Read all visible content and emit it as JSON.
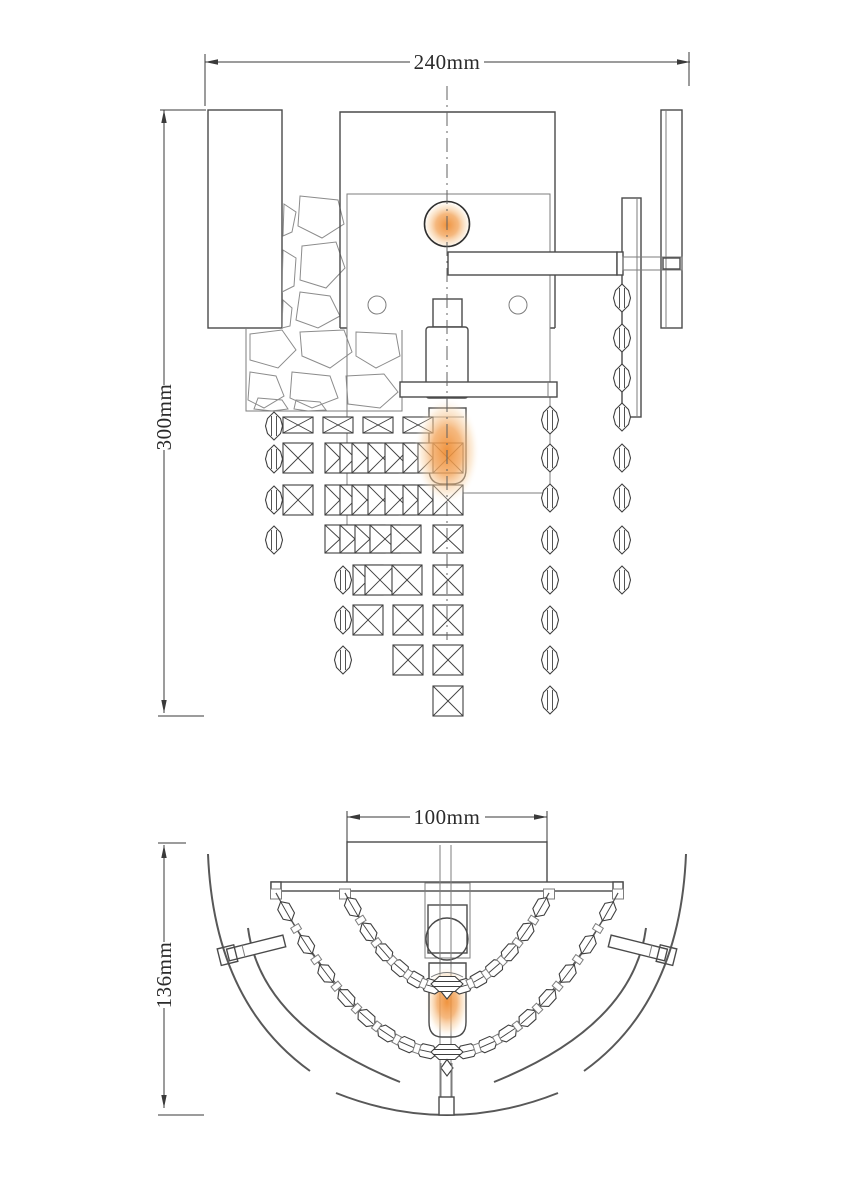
{
  "title": "Wall lamp technical drawing",
  "dimensions": {
    "front_width": "240mm",
    "front_height": "300mm",
    "shade_width": "100mm",
    "shade_depth": "136mm"
  },
  "colors": {
    "background": "#ffffff",
    "line_dark": "#4a4a4a",
    "line_thin": "#7d7d7d",
    "glow_core": "#ee8a2e",
    "glow_mid": "#f3a75f",
    "glow_soft": "#f9d6ab"
  },
  "views": {
    "front": {
      "square_size": 30,
      "square_rows": [
        {
          "y": 417,
          "h": 16,
          "xs": [
            283,
            323,
            363,
            403
          ]
        },
        {
          "y": 443,
          "h": 30,
          "xs": [
            283,
            325,
            340,
            352,
            368,
            385,
            403,
            418,
            433
          ]
        },
        {
          "y": 485,
          "h": 30,
          "xs": [
            283,
            325,
            340,
            352,
            368,
            385,
            403,
            418,
            433
          ]
        },
        {
          "y": 525,
          "h": 28,
          "xs": [
            325,
            340,
            355,
            370,
            391,
            433
          ]
        },
        {
          "y": 565,
          "h": 30,
          "xs": [
            353,
            365,
            392,
            433
          ]
        },
        {
          "y": 605,
          "h": 30,
          "xs": [
            353,
            393,
            433
          ]
        },
        {
          "y": 645,
          "h": 30,
          "xs": [
            393,
            433
          ]
        },
        {
          "y": 686,
          "h": 30,
          "xs": [
            433
          ]
        }
      ],
      "bead_columns": [
        {
          "x": 274,
          "ys": [
            426,
            459,
            500,
            540
          ]
        },
        {
          "x": 343,
          "ys": [
            580,
            620,
            660
          ]
        },
        {
          "x": 550,
          "ys": [
            420,
            458,
            498,
            540,
            580,
            620,
            660,
            700
          ]
        },
        {
          "x": 622,
          "ys": [
            298,
            338,
            378,
            417,
            458,
            498,
            540,
            580
          ]
        }
      ]
    },
    "bottom": {
      "chains": [
        {
          "x1": 345,
          "x2": 549,
          "y": 893,
          "sag": 1084,
          "beads": 13
        },
        {
          "x1": 276,
          "x2": 618,
          "y": 893,
          "sag": 1214,
          "beads": 17
        }
      ]
    }
  }
}
